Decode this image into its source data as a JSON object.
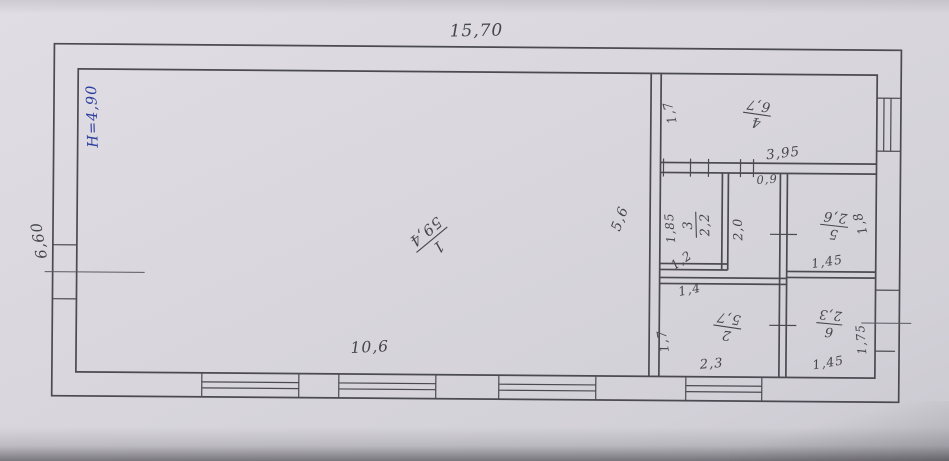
{
  "meta": {
    "drawing_type": "hand-drawn building floor plan, pen on paper"
  },
  "colors": {
    "paper": "#d9d7dd",
    "ink": "#4b4a52",
    "blue_ink": "#2b3da0"
  },
  "overall": {
    "width_top": "15,70",
    "side_left": "6,60",
    "height_note": "Н=4,90",
    "bottom_inner_width": "10,6",
    "hall_depth": "5,6"
  },
  "rooms": [
    {
      "num": "1",
      "area": "59,4"
    },
    {
      "num": "2",
      "area": "5,7"
    },
    {
      "num": "3",
      "area": "2,2"
    },
    {
      "num": "4",
      "area": "6,7"
    },
    {
      "num": "5",
      "area": "2,6"
    },
    {
      "num": "6",
      "area": "2,3"
    }
  ],
  "dims": {
    "room4_left": "1,7",
    "room4_width": "3,95",
    "door_width": "0,9",
    "room3_left": "1,85",
    "room3_inner": "1,2",
    "room3_width": "1,4",
    "corridor": "2,0",
    "room5_right": "1,8",
    "room5_width": "1,45",
    "room2_left": "1,7",
    "room2_width": "2,3",
    "room6_right": "1,75",
    "room6_width": "1,45"
  }
}
